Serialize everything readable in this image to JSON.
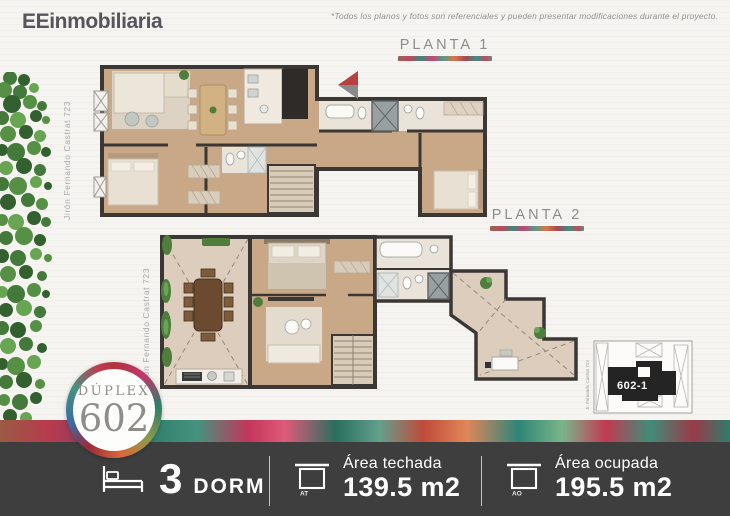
{
  "header": {
    "logo_bold": "EE",
    "logo_rest": "inmobiliaria",
    "disclaimer": "*Todos los planos y fotos son referenciales y pueden presentar modificaciones durante el proyecto."
  },
  "plans": {
    "planta1": {
      "label": "PLANTA 1",
      "street": "Jirón Fernando Castrat 723"
    },
    "planta2": {
      "label": "PLANTA 2",
      "street": "Jirón Fernando Castrat 723"
    }
  },
  "keyplan": {
    "unit": "602-1",
    "street": "Jr. Fernando Castrat 723"
  },
  "badge": {
    "title": "DÚPLEX",
    "number": "602"
  },
  "stats": {
    "dorm": {
      "icon": "bed-icon",
      "value": "3",
      "unit": "DORM"
    },
    "techada": {
      "icon": "area-techada-icon",
      "abbr": "AT",
      "label": "Área techada",
      "value": "139.5 m2"
    },
    "ocupada": {
      "icon": "area-ocupada-icon",
      "abbr": "AO",
      "label": "Área ocupada",
      "value": "195.5 m2"
    }
  },
  "colors": {
    "bar_bg": "#3e3e3e",
    "wall": "#3b3734",
    "floor_tan": "#c9a888",
    "floor_light": "#e9e3d9",
    "terrace": "#dccdbc",
    "palette": [
      "#b0343c",
      "#c2366b",
      "#2e7d6b",
      "#8a9a4a",
      "#d86a3a",
      "#3a6ea5",
      "#45937f",
      "#c23a52"
    ]
  }
}
